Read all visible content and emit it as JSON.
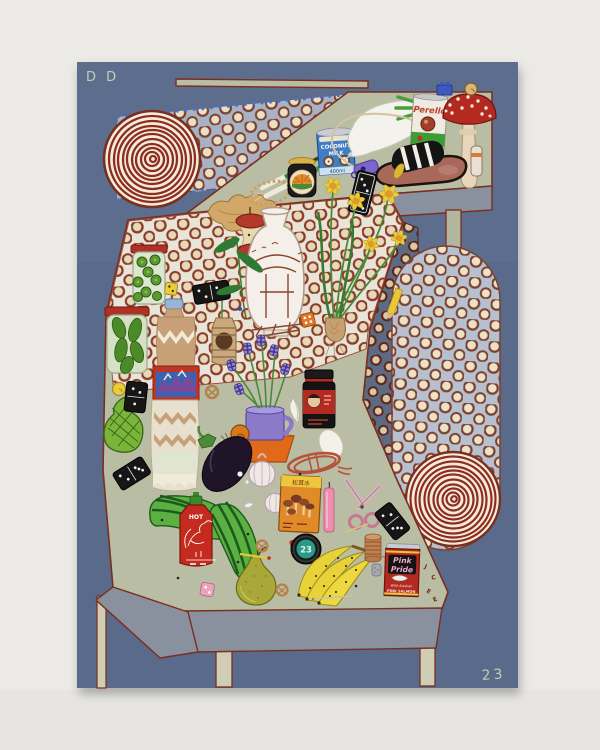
{
  "artwork": {
    "title_signature": "D D",
    "year_signature": "23",
    "labels": {
      "perello": "Perello",
      "coconut1": "COCONUT",
      "coconut2": "MILK",
      "coconut_vol": "400ml",
      "hot": "HOT",
      "tape": "23",
      "matsutake": "松茸水",
      "pinkpride1": "Pink",
      "pinkpride2": "Pride",
      "pinkpride3": "Wild Alaskan",
      "pinkpride4": "PINK SALMON",
      "scatter1": "J",
      "scatter2": "C",
      "scatter3": "E",
      "scatter4": "E"
    },
    "palette": {
      "wall": "#ebeae7",
      "canvas_blue": "#5a6b8a",
      "table_sage": "#b9bda4",
      "trim_maroon": "#7a2e1f",
      "cloth_white": "#e9e4d8",
      "band_blue": "#a8b2c2",
      "capsule_blue": "#b6c0cf",
      "sash_slate": "#5d6a84",
      "spiral_red": "#8e2c1d",
      "apron_gray": "#8a919e",
      "leg_cream": "#cfcdb3",
      "signature_green": "#c6cdb0"
    },
    "objects": [
      "spiral rug top-left",
      "spiral rug bottom-right",
      "polka-dot band",
      "polka-dot tablecloth",
      "polka-dot capsule leg",
      "dark dotted sash",
      "fly agaric mushroom",
      "Perello olive can",
      "coconut milk can",
      "spring onions",
      "white radish with leaf fork",
      "whistle with cord",
      "slide sandal",
      "dominoes",
      "blue toy brick",
      "snail shell",
      "glue stick",
      "ginger root",
      "bead necklace",
      "chilli jar with sunrise label",
      "apple core",
      "olive jar",
      "pickle jar",
      "water bottle with mountain label",
      "twine-wrapped hanging jar",
      "white vase with pavilion drawing",
      "leafy sprig with beads",
      "daffodils with bulb",
      "pencil",
      "yellow dice",
      "orange dice",
      "pink dice",
      "avocado-shaped board",
      "checkered fritillaries in purple mug on orange pot",
      "snail",
      "eggplant",
      "garlic bulbs",
      "chilli sauce jar with portrait label",
      "egg",
      "rope coil",
      "white feather",
      "matsutake packet",
      "pink candle",
      "pink scissors",
      "tape measure 23",
      "sriracha rooster bottle",
      "striped gourds",
      "pear",
      "banana bunch",
      "copper wire spool",
      "thimble",
      "pink salmon can",
      "pretzels",
      "letter beads",
      "needle and matchstick"
    ]
  }
}
